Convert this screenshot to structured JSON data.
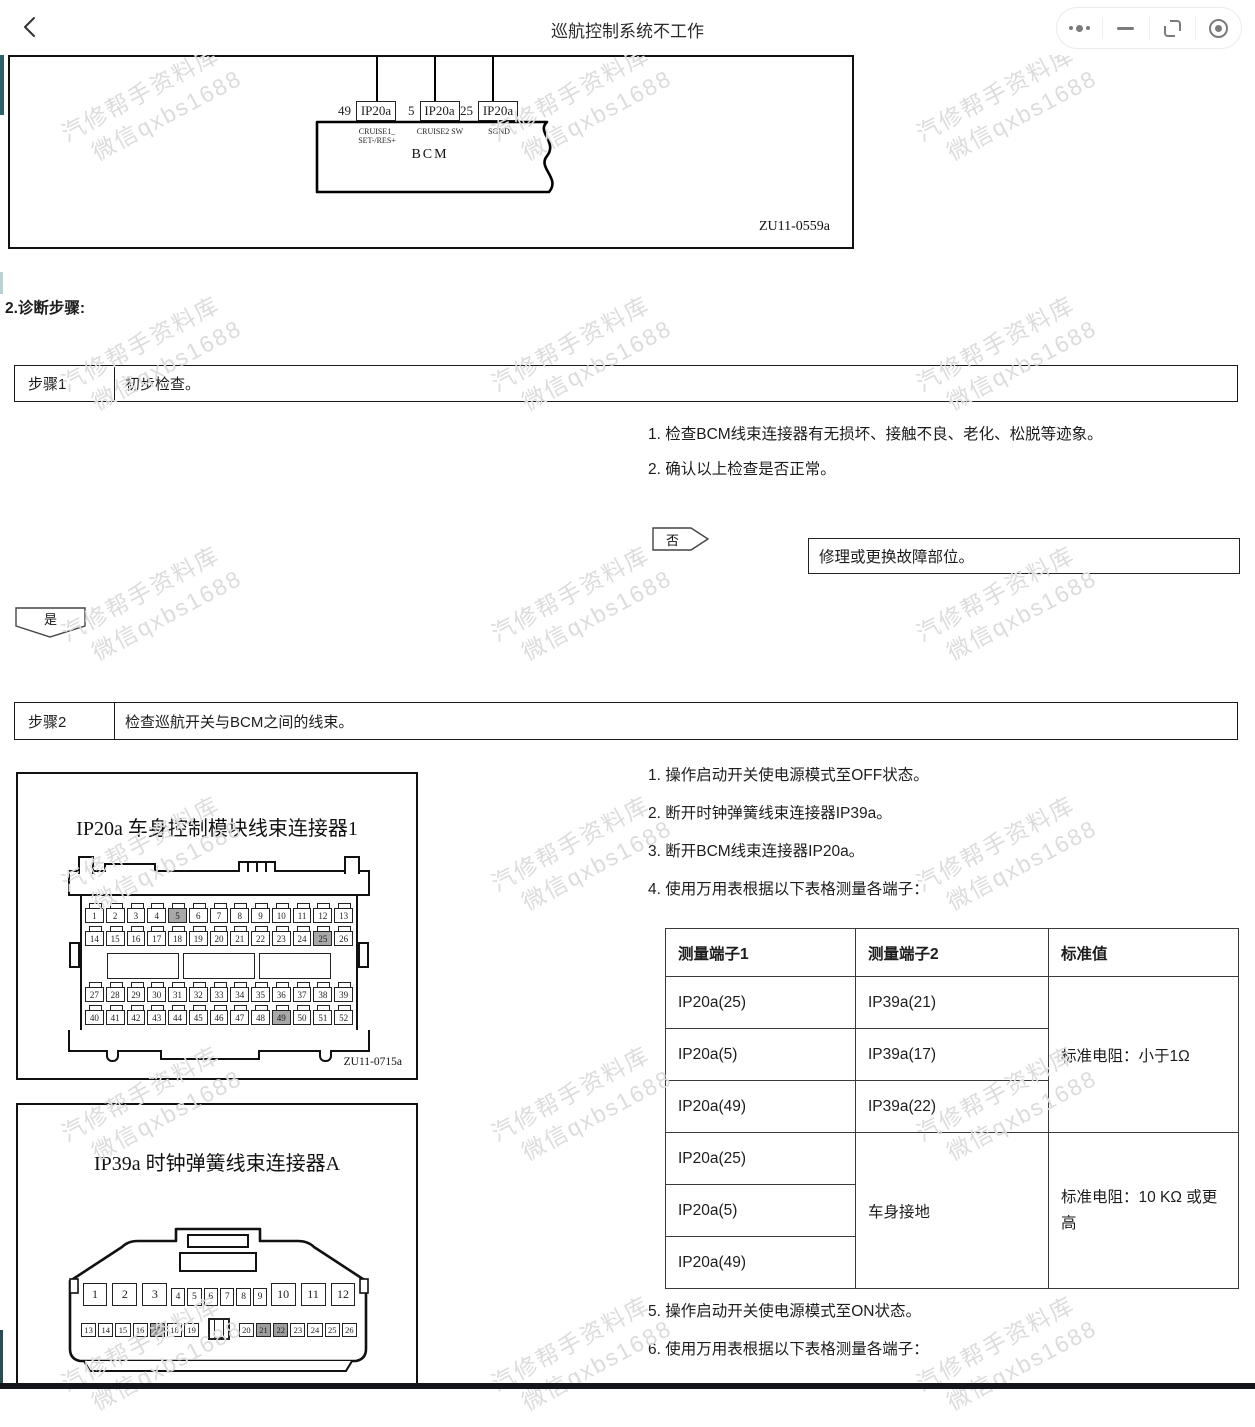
{
  "topbar": {
    "title": "巡航控制系统不工作"
  },
  "wiring_diagram": {
    "module_label": "BCM",
    "figure_code": "ZU11-0559a",
    "pins": [
      {
        "number": "49",
        "connector": "IP20a",
        "signal": "CRUISE1_\nSET-/RES+"
      },
      {
        "number": "5",
        "connector": "IP20a",
        "signal": "CRUISE2 SW"
      },
      {
        "number": "25",
        "connector": "IP20a",
        "signal": "SGND"
      }
    ]
  },
  "section_heading": "2.诊断步骤:",
  "steps": [
    {
      "label": "步骤1",
      "description": "初步检查。"
    },
    {
      "label": "步骤2",
      "description": "检查巡航开关与BCM之间的线束。"
    }
  ],
  "step1": {
    "items": [
      "1. 检查BCM线束连接器有无损坏、接触不良、老化、松脱等迹象。",
      "2. 确认以上检查是否正常。"
    ],
    "no_label": "否",
    "no_action": "修理或更换故障部位。",
    "yes_label": "是"
  },
  "step2": {
    "items_before_table": [
      "1. 操作启动开关使电源模式至OFF状态。",
      "2. 断开时钟弹簧线束连接器IP39a。",
      "3. 断开BCM线束连接器IP20a。",
      "4. 使用万用表根据以下表格测量各端子："
    ],
    "items_after_table": [
      "5. 操作启动开关使电源模式至ON状态。",
      "6. 使用万用表根据以下表格测量各端子："
    ],
    "table": {
      "headers": [
        "测量端子1",
        "测量端子2",
        "标准值"
      ],
      "rows": [
        [
          "IP20a(25)",
          "IP39a(21)"
        ],
        [
          "IP20a(5)",
          "IP39a(17)"
        ],
        [
          "IP20a(49)",
          "IP39a(22)"
        ],
        [
          "IP20a(25)"
        ],
        [
          "IP20a(5)"
        ],
        [
          "IP20a(49)"
        ]
      ],
      "merged": {
        "standard_1": "标准电阻：小于1Ω",
        "terminal2_ground": "车身接地",
        "standard_2": "标准电阻：10 KΩ 或更高"
      }
    }
  },
  "connector_figures": [
    {
      "title": "IP20a 车身控制模块线束连接器1",
      "figure_code": "ZU11-0715a",
      "pin_rows": [
        [
          1,
          2,
          3,
          4,
          5,
          6,
          7,
          8,
          9,
          10,
          11,
          12,
          13
        ],
        [
          14,
          15,
          16,
          17,
          18,
          19,
          20,
          21,
          22,
          23,
          24,
          25,
          26
        ],
        [
          27,
          28,
          29,
          30,
          31,
          32,
          33,
          34,
          35,
          36,
          37,
          38,
          39
        ],
        [
          40,
          41,
          42,
          43,
          44,
          45,
          46,
          47,
          48,
          49,
          50,
          51,
          52
        ]
      ],
      "highlighted_pins": [
        5,
        25,
        49
      ]
    },
    {
      "title": "IP39a 时钟弹簧线束连接器A",
      "row1_groups": [
        {
          "style": "big",
          "pins": [
            1,
            2,
            3
          ]
        },
        {
          "style": "small",
          "pins": [
            4,
            5,
            6,
            7,
            8,
            9
          ]
        },
        {
          "style": "big",
          "pins": [
            10,
            11,
            12
          ]
        }
      ],
      "row2_groups": [
        {
          "style": "row2",
          "pins": [
            13,
            14,
            15,
            16,
            17,
            18,
            19
          ]
        },
        {
          "style": "key",
          "pins": []
        },
        {
          "style": "row2",
          "pins": [
            20,
            21,
            22,
            23,
            24,
            25,
            26
          ]
        }
      ],
      "highlighted_pins": [
        17,
        21,
        22
      ]
    }
  ],
  "watermark": {
    "line1": "汽修帮手资料库",
    "line2": "微信qxbs1688",
    "color": "#dcdcdc"
  }
}
